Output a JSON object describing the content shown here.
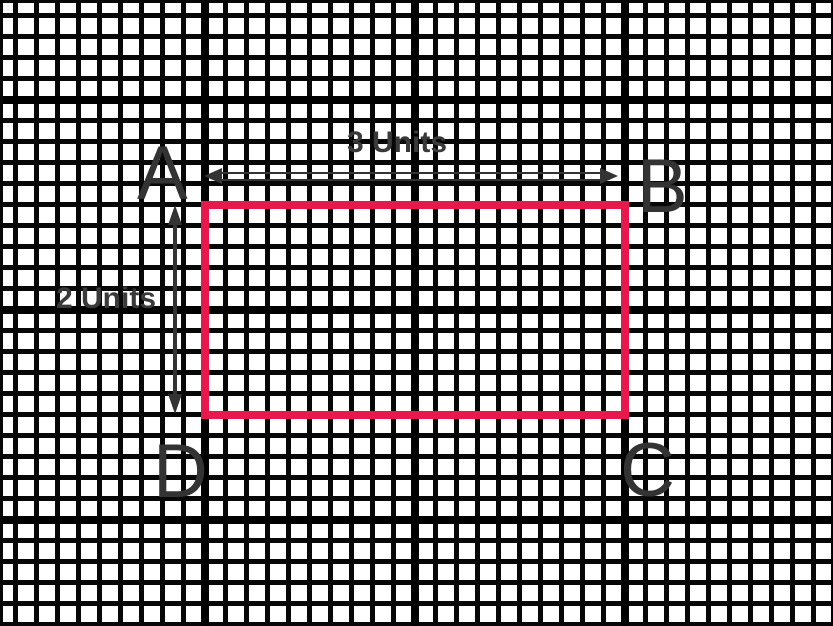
{
  "diagram": {
    "type": "rectangle-on-graph-paper",
    "corners": {
      "a": "A",
      "b": "B",
      "c": "C",
      "d": "D"
    },
    "width_dimension": {
      "label": "3 Units",
      "value": 3,
      "unit": "Units"
    },
    "height_dimension": {
      "label": "2 Units",
      "value": 2,
      "unit": "Units"
    },
    "colors": {
      "rectangle_stroke": "#e8174c",
      "grid_minor": "#070707",
      "grid_major": "#000000",
      "annotation": "#333333",
      "paper": "#ffffff"
    }
  }
}
